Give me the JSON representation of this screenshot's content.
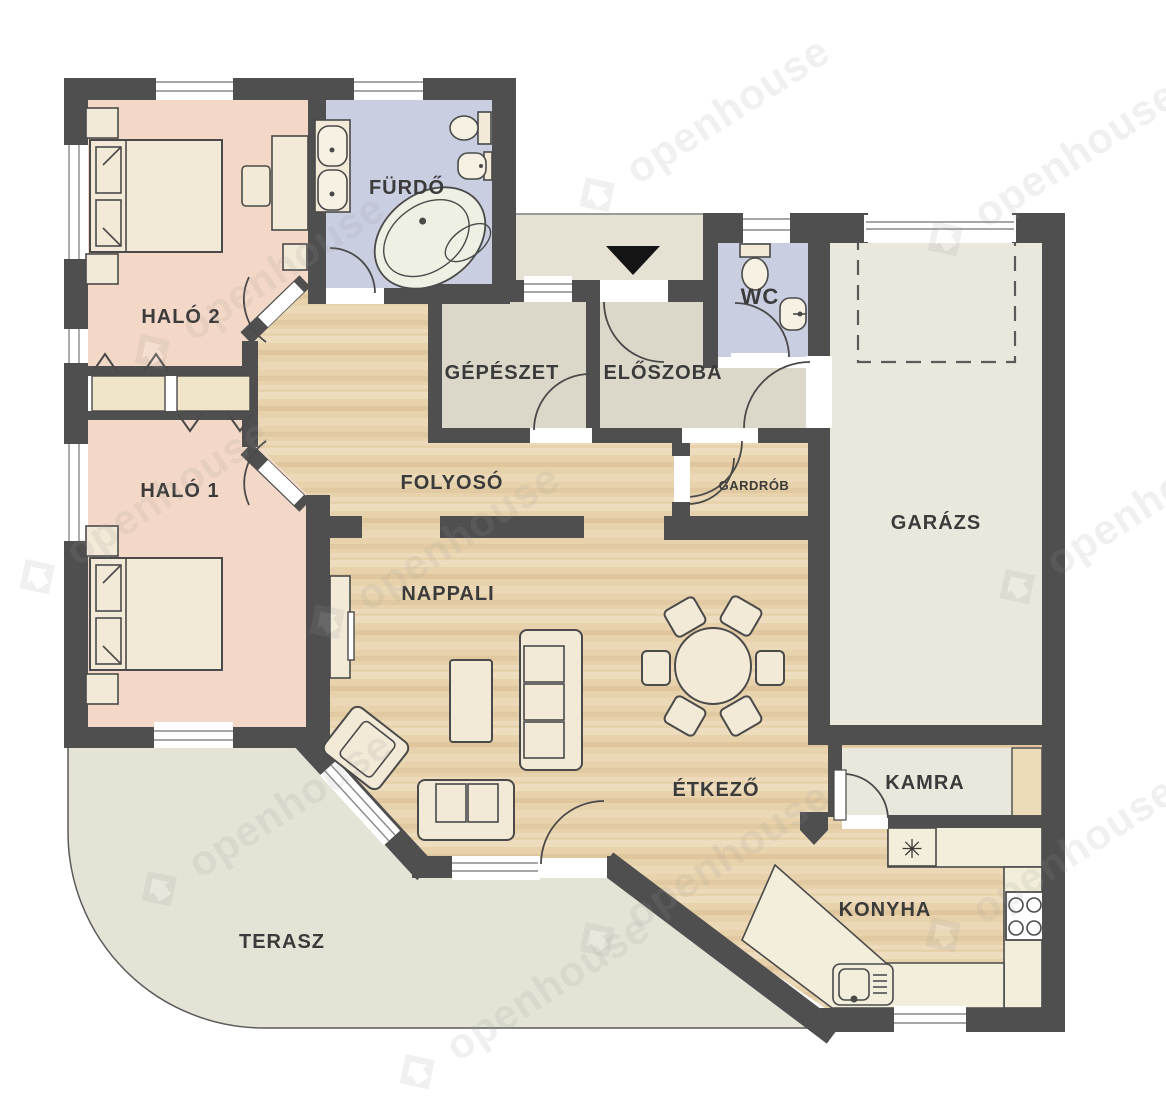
{
  "watermark": {
    "text": "openhouse"
  },
  "symbols": {
    "fridge": "✳"
  },
  "colors": {
    "wall": "#4f4f4f",
    "outline": "#4a4a4a",
    "label": "#3b3b3b",
    "wood": "#e8d2ab",
    "bedroom": "#f4d8c7",
    "bathroom": "#c9cee1",
    "utility": "#dcd8c9",
    "garage": "#eae8dc",
    "terrace": "#e4e3d6",
    "porch": "#e5e2d3",
    "furniture": "#f2ead7",
    "counter": "#f3eedb",
    "closet": "#f0e4c9",
    "shelf": "#ecdbb8",
    "arrow": "#141414",
    "watermark": "#9b9b9b"
  },
  "rooms": {
    "halo2": {
      "label": "HALÓ 2"
    },
    "furdo": {
      "label": "FÜRDŐ"
    },
    "gepeszet": {
      "label": "GÉPÉSZET"
    },
    "eloszoba": {
      "label": "ELŐSZOBA"
    },
    "wc": {
      "label": "WC"
    },
    "garazs": {
      "label": "GARÁZS"
    },
    "halo1": {
      "label": "HALÓ 1"
    },
    "folyoso": {
      "label": "FOLYOSÓ"
    },
    "gardrob": {
      "label": "GARDRÓB"
    },
    "nappali": {
      "label": "NAPPALI"
    },
    "etkezo": {
      "label": "ÉTKEZŐ"
    },
    "kamra": {
      "label": "KAMRA"
    },
    "konyha": {
      "label": "KONYHA"
    },
    "terasz": {
      "label": "TERASZ"
    }
  }
}
